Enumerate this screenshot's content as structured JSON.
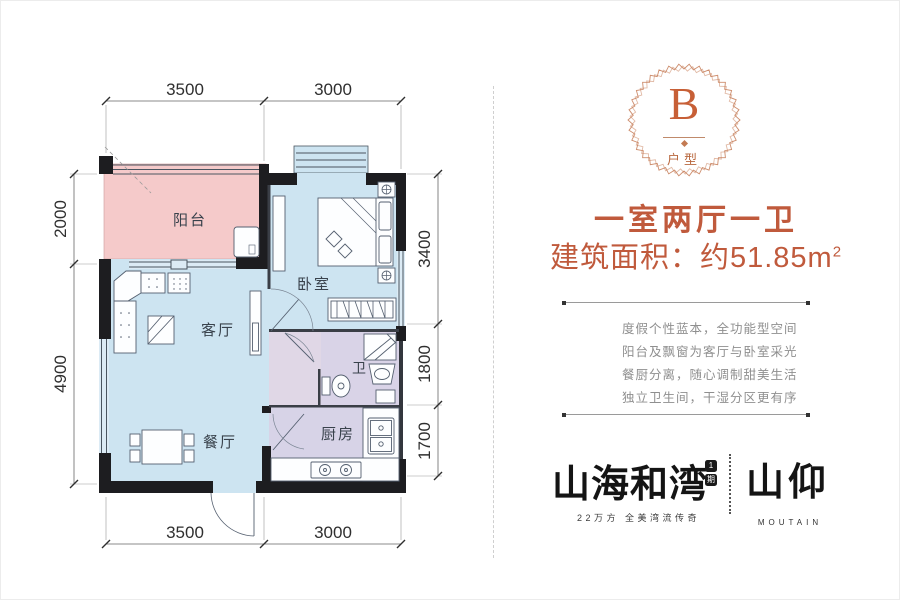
{
  "plan": {
    "rooms": {
      "balcony": "阳台",
      "bedroom": "卧室",
      "living": "客厅",
      "dining": "餐厅",
      "bath": "卫",
      "kitchen": "厨房"
    },
    "dimensions": {
      "top": [
        "3500",
        "3000"
      ],
      "bottom": [
        "3500",
        "3000"
      ],
      "left": [
        "2000",
        "4900"
      ],
      "right": [
        "3400",
        "1800",
        "1700"
      ]
    }
  },
  "panel": {
    "badge": {
      "letter": "B",
      "label": "户型"
    },
    "headline": "一室两厅一卫",
    "area_prefix": "建筑面积：约51.85m",
    "area_exponent": "2",
    "description_lines": [
      "度假个性蓝本，全功能型空间",
      "阳台及飘窗为客厅与卧室采光",
      "餐厨分离，随心调制甜美生活",
      "独立卫生间，干湿分区更有序"
    ],
    "brand": {
      "primary": "山海和湾",
      "primary_badge_top": "1",
      "primary_badge_bottom": "期",
      "tagline": "22万方 全美湾流传奇",
      "secondary": "山仰",
      "secondary_sub": "MOUTAIN"
    }
  },
  "colors": {
    "accent": "#c05a3c",
    "badge_ring": "#c8815d",
    "balcony_fill": "#f5caca",
    "room_fill": "#cde4f1",
    "wet_fill": "#d9d3e7",
    "wall": "#1d1d20",
    "line_work": "#556070"
  }
}
